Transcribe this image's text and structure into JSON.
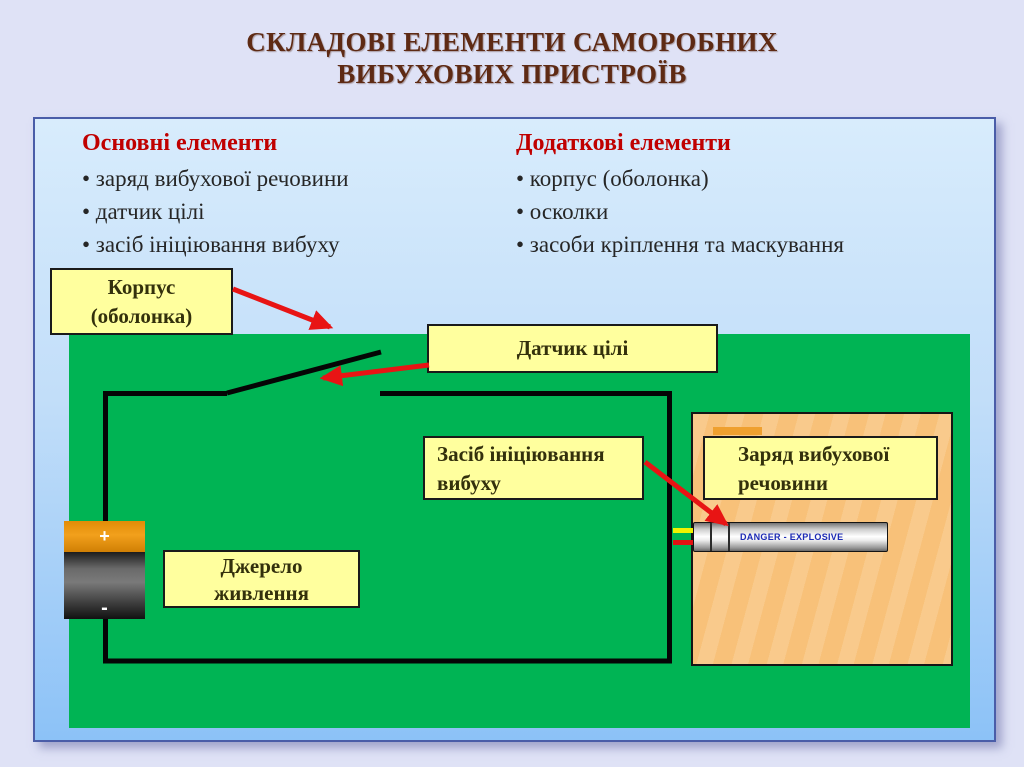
{
  "slide": {
    "title_line1": "СКЛАДОВІ ЕЛЕМЕНТИ САМОРОБНИХ",
    "title_line2": "ВИБУХОВИХ ПРИСТРОЇВ"
  },
  "columns": [
    {
      "header": "Основні елементи",
      "items": [
        "• заряд вибухової речовини",
        "• датчик цілі",
        "• засіб ініціювання вибуху"
      ]
    },
    {
      "header": "Додаткові елементи",
      "items": [
        "• корпус (оболонка)",
        "• осколки",
        "• засоби кріплення та маскування"
      ]
    }
  ],
  "diagram": {
    "labels": {
      "case_line1": "Корпус",
      "case_line2": "(оболонка)",
      "sensor": "Датчик цілі",
      "initiator_line1": "Засіб ініціювання",
      "initiator_line2": "вибуху",
      "charge_line1": "Заряд вибухової",
      "charge_line2": "речовини",
      "power_line1": "Джерело",
      "power_line2": "живлення"
    },
    "battery": {
      "plus": "+",
      "minus": "-"
    },
    "detonator_text": "DANGER - EXPLOSIVE",
    "icons": {
      "battery": "battery-icon",
      "detonator": "detonator-icon",
      "switch": "open-switch-wire",
      "pointers": "red-arrow-pointers"
    }
  },
  "colors": {
    "slide_bg": "#dfe2f6",
    "panel_border": "#4a5da8",
    "panel_gradient_top": "#d8ecfc",
    "panel_gradient_bottom": "#8cc2f7",
    "title_text": "#5e2a14",
    "header_red": "#c00000",
    "body_text": "#262626",
    "device_green": "#00b454",
    "label_yellow": "#ffff9e",
    "charge_orange": "#f8c179",
    "charge_strip_orange": "#efa02f",
    "battery_cap_orange": "#ef9a14",
    "wire_black": "#050505",
    "arrow_red": "#e81414",
    "lead_yellow": "#f2f200",
    "lead_red": "#e21212",
    "danger_text_blue": "#1c2ab5"
  }
}
